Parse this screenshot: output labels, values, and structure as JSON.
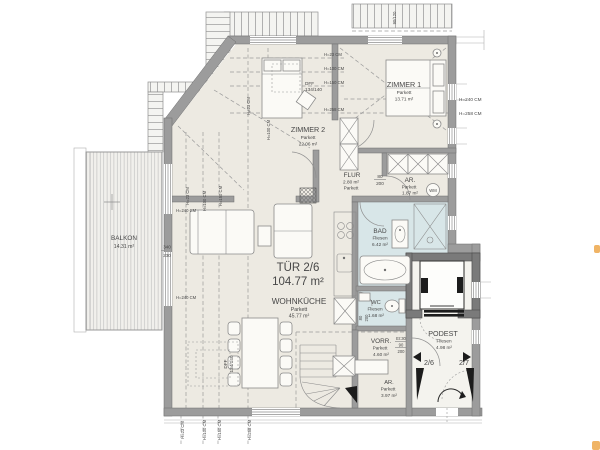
{
  "colors": {
    "wall": "#9c9c9c",
    "wet_room": "#d8e6e8",
    "floor": "#edeae2",
    "elevator_wall": "#7a7a7a"
  },
  "unit": {
    "name": "TÜR 2/6",
    "area": "104.77 m²"
  },
  "rooms": {
    "zimmer1": {
      "name": "ZIMMER 1",
      "floor": "Parkett",
      "area": "13.71 m²"
    },
    "zimmer2": {
      "name": "ZIMMER 2",
      "floor": "Parkett",
      "area": "22.06 m²"
    },
    "flur": {
      "name": "FLUR",
      "floor": "Parkett",
      "area": "2.80 m²"
    },
    "ar_top": {
      "name": "AR.",
      "floor": "Parkett",
      "area": "1.87 m²"
    },
    "bad": {
      "name": "BAD",
      "floor": "Fliesen",
      "area": "6.42 m²"
    },
    "wc": {
      "name": "WC",
      "floor": "Fliesen",
      "area": "1.68 m²"
    },
    "wohnkueche": {
      "name": "WOHNKÜCHE",
      "floor": "Parkett",
      "area": "45.77 m²"
    },
    "vorr": {
      "name": "VORR.",
      "floor": "Parkett",
      "area": "4.60 m²"
    },
    "ar_bottom": {
      "name": "AR.",
      "floor": "Parkett",
      "area": "3.97 m²"
    },
    "podest": {
      "name": "PODEST",
      "floor": "Fliesen",
      "area": "4.98 m²"
    },
    "balkon": {
      "name": "BALKON",
      "area": "14.31 m²"
    }
  },
  "heights": {
    "h23": "H=23 CM",
    "h100": "H=100 CM",
    "h150": "H=150 CM",
    "h240": "H=240 CM",
    "h258": "H=258 CM"
  },
  "tags": {
    "door_width": "80",
    "door_height": "200",
    "fire_rating": "EI:30",
    "fire_door_width": "90",
    "apartment_door_left": "2/6",
    "apartment_door_right": "2/7",
    "roof_window": "DFF",
    "roof_window_size": "134/140",
    "window_size": "90/120",
    "balcony_width": "340",
    "balcony_height": "230",
    "washing_machine": "WM"
  }
}
